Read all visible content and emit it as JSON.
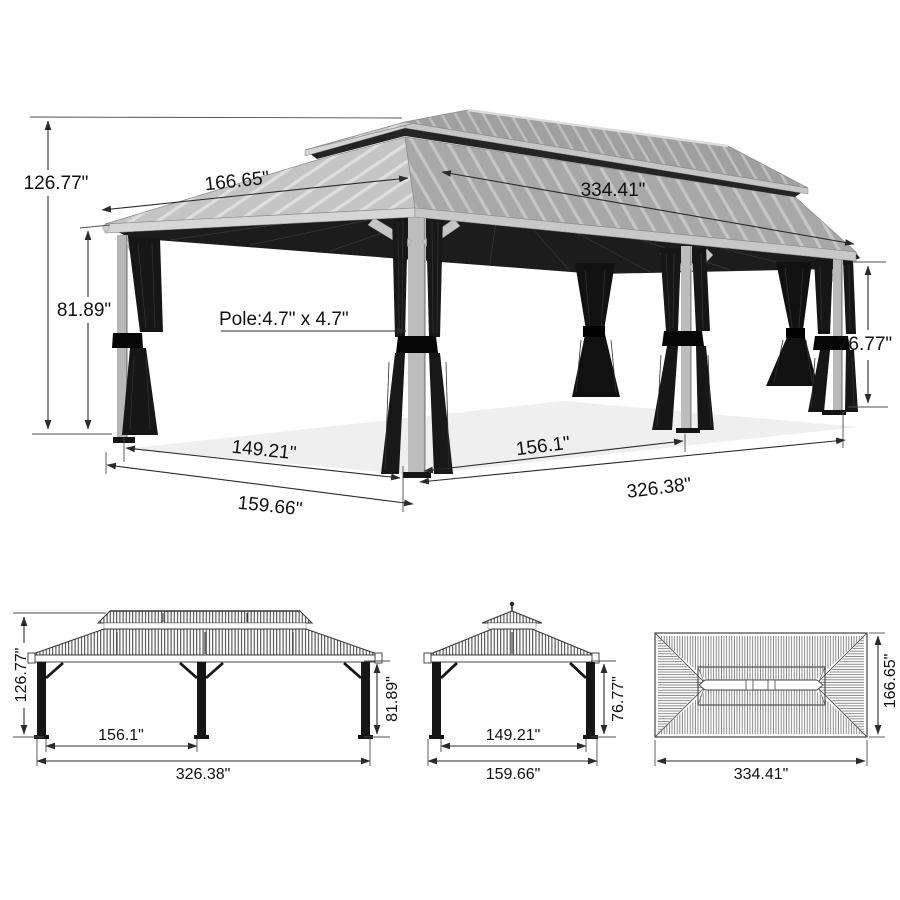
{
  "perspective_view": {
    "total_height": "126.77\"",
    "roof_width": "166.65\"",
    "roof_length": "334.41\"",
    "eave_height": "81.89\"",
    "pole_size": "Pole:4.7\" x 4.7\"",
    "post_height": "76.77\"",
    "side_inner_span": "149.21\"",
    "front_inner_span": "156.1\"",
    "side_outer_span": "159.66\"",
    "front_outer_span": "326.38\""
  },
  "front_elevation": {
    "total_height": "126.77\"",
    "eave_height": "81.89\"",
    "inner_span": "156.1\"",
    "outer_span": "326.38\""
  },
  "side_elevation": {
    "post_height": "76.77\"",
    "inner_span": "149.21\"",
    "outer_span": "159.66\""
  },
  "top_plan": {
    "roof_length": "334.41\"",
    "roof_width": "166.65\""
  }
}
